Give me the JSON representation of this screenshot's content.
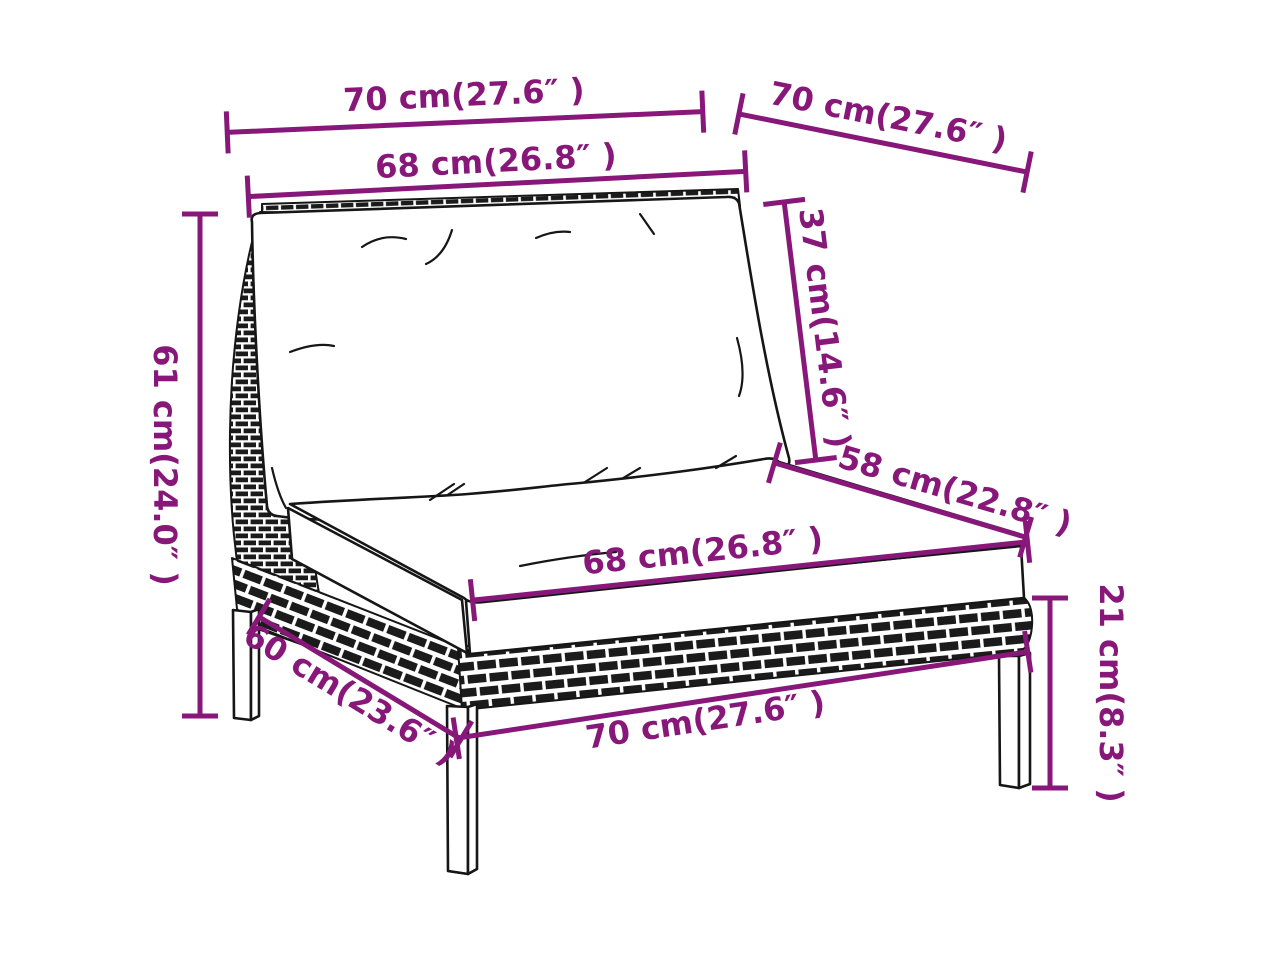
{
  "diagram": {
    "accent_color": "#87187A",
    "ink_color": "#161616",
    "background_color": "#FFFFFF",
    "dimensions": [
      {
        "id": "top-width",
        "label": "70 cm(27.6″ )"
      },
      {
        "id": "top-depth",
        "label": "70 cm(27.6″ )"
      },
      {
        "id": "back-cushion-width",
        "label": "68 cm(26.8″ )"
      },
      {
        "id": "back-cushion-height",
        "label": "37 cm(14.6″ )"
      },
      {
        "id": "seat-depth",
        "label": "58 cm(22.8″ )"
      },
      {
        "id": "seat-width",
        "label": "68 cm(26.8″ )"
      },
      {
        "id": "back-height",
        "label": "61 cm(24.0″ )"
      },
      {
        "id": "base-side-depth",
        "label": "60 cm(23.6″ )"
      },
      {
        "id": "base-width",
        "label": "70 cm(27.6″ )"
      },
      {
        "id": "leg-height",
        "label": "21 cm(8.3″ )"
      }
    ]
  }
}
